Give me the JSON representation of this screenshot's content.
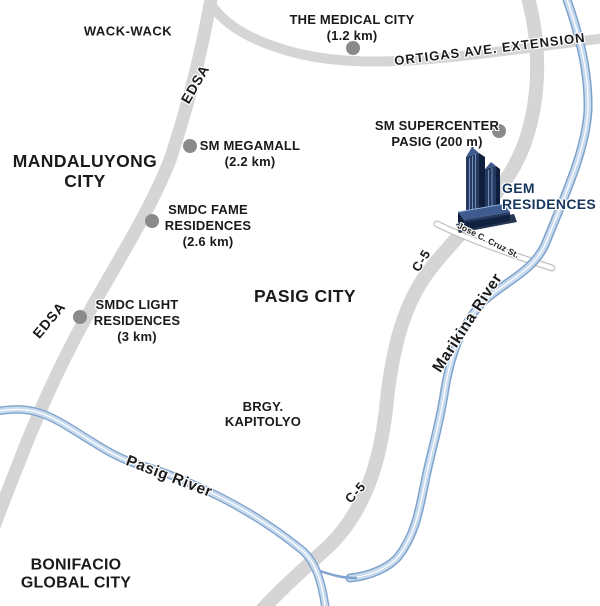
{
  "map": {
    "title": "GEM Residences vicinity map",
    "areas": {
      "wack_wack": "WACK-WACK",
      "mandaluyong": "MANDALUYONG CITY",
      "pasig_city": "PASIG CITY",
      "brgy_kapitolyo": "BRGY. KAPITOLYO",
      "bgc": "BONIFACIO GLOBAL CITY"
    },
    "roads": {
      "edsa": "EDSA",
      "ortigas_ave": "ORTIGAS AVE. EXTENSION",
      "c5": "C-5",
      "jose_cruz": "Jose C. Cruz St."
    },
    "rivers": {
      "pasig": "Pasig River",
      "marikina": "Marikina River"
    },
    "pois": {
      "medical_city": {
        "lines": [
          "THE MEDICAL CITY",
          "(1.2 km)"
        ]
      },
      "sm_megamall": {
        "lines": [
          "SM MEGAMALL",
          "(2.2 km)"
        ]
      },
      "sm_supercenter": {
        "lines": [
          "SM SUPERCENTER",
          "PASIG (200 m)"
        ]
      },
      "smdc_fame": {
        "name": "SMDC FAME RESIDENCES",
        "distance": "(2.6 km)"
      },
      "smdc_light": {
        "name": "SMDC LIGHT RESIDENCES",
        "distance": "(3 km)"
      }
    },
    "property": {
      "lines": [
        "GEM",
        "RESIDENCES"
      ]
    }
  },
  "theme": {
    "bg": "#ffffff",
    "ink": "#1a1a1a",
    "blue": "#17375e",
    "road": "#d5d5d5",
    "road-edge": "#c2c2c2",
    "river-edge": "#7fa3cc",
    "river-fill": "#c8daed",
    "marker": "#8a8a8a",
    "bldg-dark": "#101f3d",
    "bldg-mid": "#26395f",
    "bldg-top": "#3f5a8e",
    "bldg-light": "#8fb0dc"
  }
}
